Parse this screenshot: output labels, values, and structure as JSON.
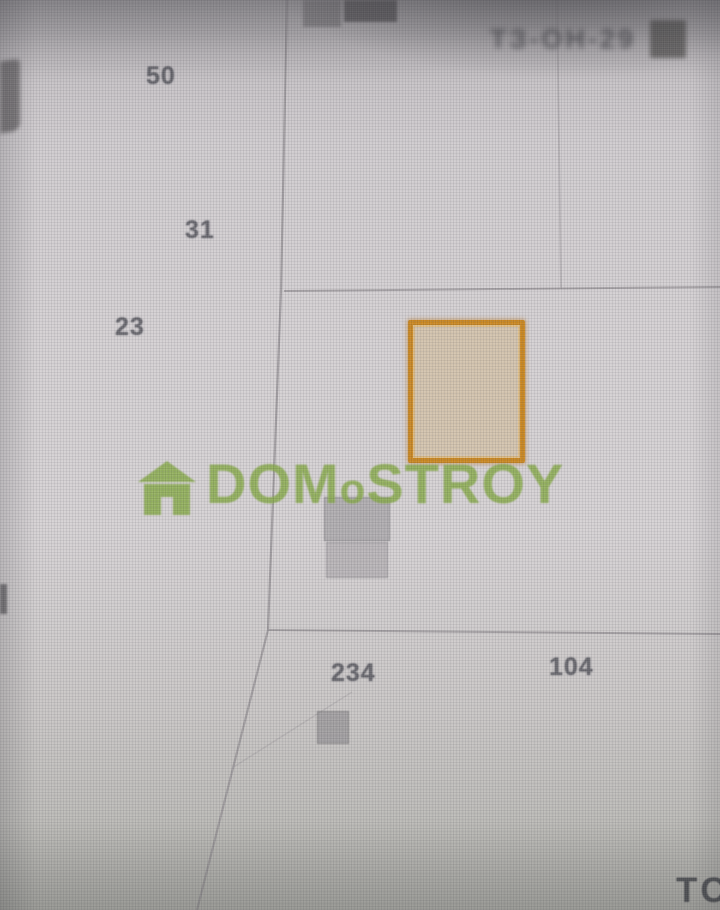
{
  "map": {
    "parcel_labels": [
      {
        "id": "50"
      },
      {
        "id": "31"
      },
      {
        "id": "23"
      },
      {
        "id": "234"
      },
      {
        "id": "104"
      }
    ],
    "corner_label": "ТС",
    "top_right_label": "ТЗ-ОН-29",
    "watermark": {
      "part1": "DOM",
      "part2": "o",
      "part3": "STROY",
      "full": "DOMoSTROY"
    },
    "colors": {
      "selected_parcel_border": "#c8851e",
      "selected_parcel_fill": "#d0b27e",
      "watermark_green": "#86a846",
      "boundary_line": "#8f8b8f"
    }
  }
}
